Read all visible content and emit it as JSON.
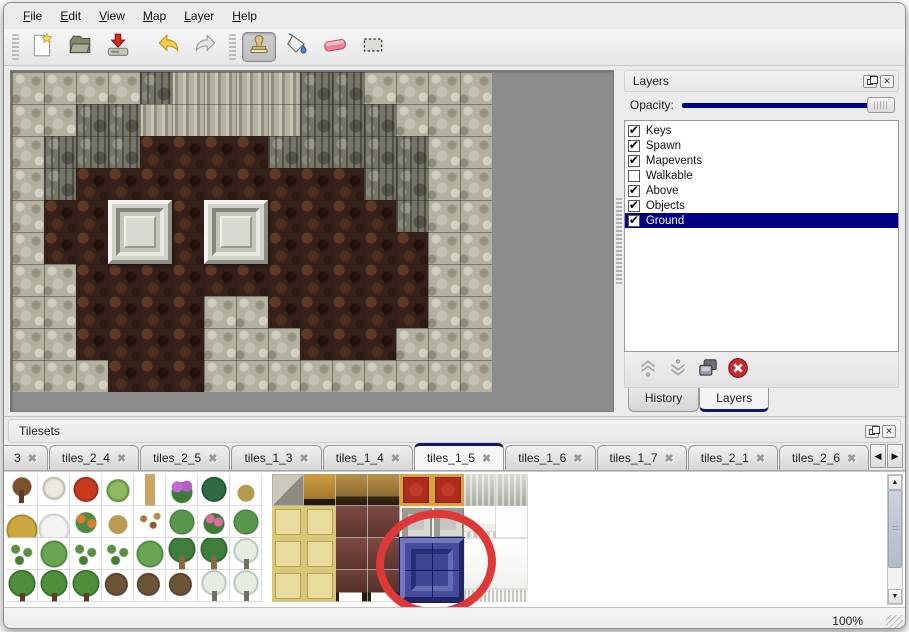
{
  "menu": {
    "items": [
      {
        "label": "File",
        "underline": 0
      },
      {
        "label": "Edit",
        "underline": 0
      },
      {
        "label": "View",
        "underline": 0
      },
      {
        "label": "Map",
        "underline": 0
      },
      {
        "label": "Layer",
        "underline": 0
      },
      {
        "label": "Help",
        "underline": 0
      }
    ]
  },
  "toolbar": {
    "groups": [
      {
        "tools": [
          {
            "icon": "new-file"
          },
          {
            "icon": "open-folder"
          },
          {
            "icon": "save"
          }
        ]
      },
      {
        "tools": [
          {
            "icon": "undo"
          },
          {
            "icon": "redo"
          }
        ]
      },
      {
        "tools": [
          {
            "icon": "stamp",
            "active": true
          },
          {
            "icon": "fill-bucket"
          },
          {
            "icon": "eraser"
          },
          {
            "icon": "select-marquee"
          }
        ]
      }
    ]
  },
  "layers_panel": {
    "title": "Layers",
    "opacity_label": "Opacity:",
    "opacity_value": 1.0,
    "layers": [
      {
        "name": "Keys",
        "checked": true,
        "selected": false
      },
      {
        "name": "Spawn",
        "checked": true,
        "selected": false
      },
      {
        "name": "Mapevents",
        "checked": true,
        "selected": false
      },
      {
        "name": "Walkable",
        "checked": false,
        "selected": false
      },
      {
        "name": "Above",
        "checked": true,
        "selected": false
      },
      {
        "name": "Objects",
        "checked": true,
        "selected": false
      },
      {
        "name": "Ground",
        "checked": true,
        "selected": true
      }
    ],
    "buttons": [
      "move-up",
      "move-down",
      "duplicate",
      "delete"
    ],
    "tabs": [
      {
        "label": "History",
        "active": false
      },
      {
        "label": "Layers",
        "active": true
      }
    ]
  },
  "tilesets_panel": {
    "title": "Tilesets",
    "tabs": [
      {
        "label": "3",
        "clipped": true
      },
      {
        "label": "tiles_2_4"
      },
      {
        "label": "tiles_2_5"
      },
      {
        "label": "tiles_1_3"
      },
      {
        "label": "tiles_1_4"
      },
      {
        "label": "tiles_1_5",
        "active": true
      },
      {
        "label": "tiles_1_6"
      },
      {
        "label": "tiles_1_7"
      },
      {
        "label": "tiles_2_1"
      },
      {
        "label": "tiles_2_6"
      }
    ],
    "tileset": {
      "tile_size": 32,
      "plant_origin_x": 2,
      "furniture_origin_x": 268,
      "plant_rows": [
        [
          "tree",
          "btree",
          "rbloom",
          "stump",
          "trunk",
          "pbush",
          "fern",
          "dgrass"
        ],
        [
          "hay",
          "snowpile",
          "oflower",
          "dry",
          "leaves",
          "lily",
          "rose",
          "lily"
        ],
        [
          "sprout",
          "bush",
          "sprout",
          "sprout",
          "bush",
          "palm",
          "palm",
          "spine"
        ],
        [
          "pine",
          "pine",
          "pine",
          "twist",
          "twist",
          "twist",
          "spine",
          "spine"
        ]
      ],
      "furniture_rows": [
        [
          "stonec",
          "gtable",
          "wood",
          "wood",
          "rcarpet",
          "rcarpet",
          "silver",
          "silver"
        ],
        [
          "mat",
          "mat",
          "maroon",
          "maroon",
          "frame",
          "frame",
          "clothtop",
          "whitet"
        ],
        [
          "mat",
          "mat",
          "maroon",
          "maroon",
          "",
          "",
          "",
          ""
        ],
        [
          "mat",
          "mat",
          "marleg",
          "marleg",
          "",
          "",
          "",
          ""
        ]
      ],
      "objects": [
        {
          "type": "blue-tile",
          "x": 396,
          "y": 64,
          "w": 64,
          "h": 64,
          "selected": true
        },
        {
          "type": "cloth",
          "x": 460,
          "y": 64,
          "w": 64,
          "h": 64
        }
      ],
      "annotation": {
        "shape": "ellipse",
        "x": 372,
        "y": 38,
        "w": 120,
        "h": 106,
        "color": "#df3838"
      }
    }
  },
  "map": {
    "tile_size": 32,
    "legend": {
      "A": "rock-scale",
      "W": "cliff-wall",
      "P": "stone-pillar",
      "F": "cobble-floor"
    },
    "grid": [
      "AAAAWPPPPWWAAAA",
      "AAWWPPPPPWWWAAA",
      "AWWWFFFFWWWWWAA",
      "AWFFFFFFFFFWWAA",
      "AFFFFFFFFFFFWAA",
      "AFFFFFFFFFFFFAA",
      "AAFFFFFFFFFFFAA",
      "AAFFFFAAFFFFFAA",
      "AAFFFFAAAFFFAAA",
      "AAAFFFAAAAAAAAA"
    ],
    "objects": [
      {
        "type": "door-frame",
        "col": 3,
        "row": 4
      },
      {
        "type": "door-frame",
        "col": 6,
        "row": 4
      }
    ]
  },
  "status_bar": {
    "zoom_level": "100%"
  },
  "colors": {
    "selection_highlight": "#000080",
    "opacity_slider": "#00008b",
    "active_tab_accent": "#14146e",
    "annotation_red": "#df3838"
  }
}
